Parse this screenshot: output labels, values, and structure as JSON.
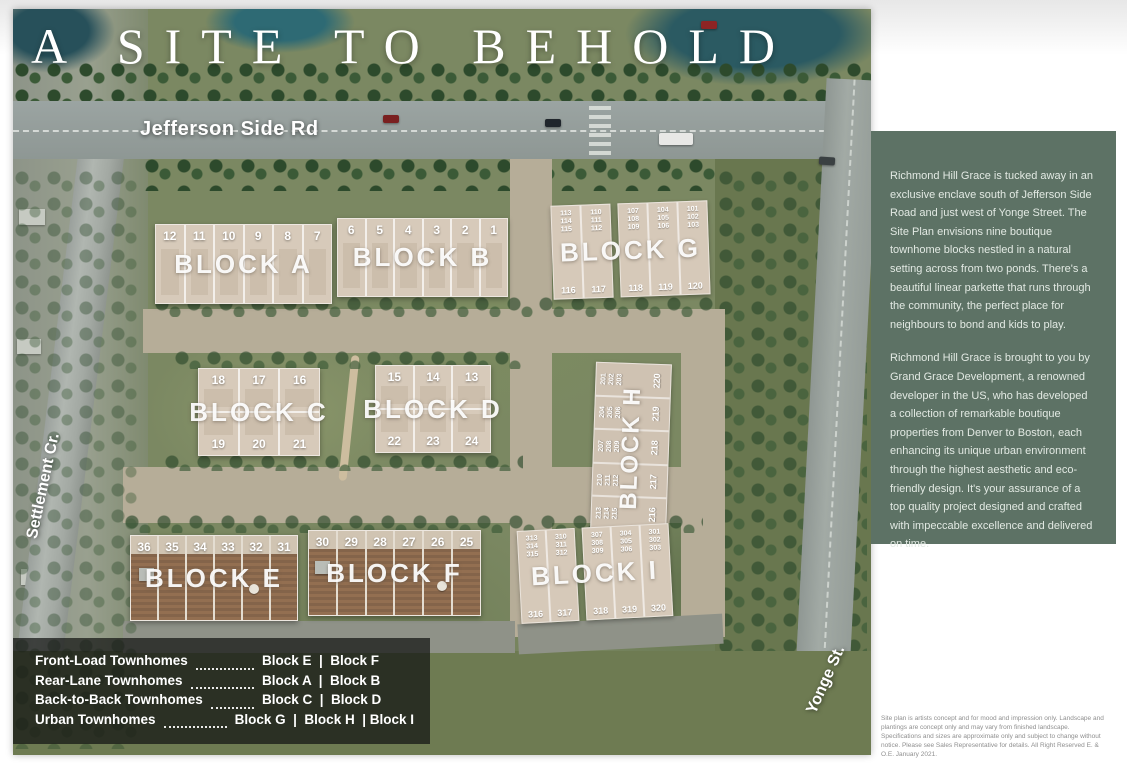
{
  "title": "A SITE TO BEHOLD",
  "streets": {
    "jefferson": "Jefferson Side Rd",
    "settlement": "Settlement Cr.",
    "yonge": "Yonge St."
  },
  "blocks": {
    "a": {
      "label": "BLOCK A",
      "units": [
        "12",
        "11",
        "10",
        "9",
        "8",
        "7"
      ]
    },
    "b": {
      "label": "BLOCK B",
      "units": [
        "6",
        "5",
        "4",
        "3",
        "2",
        "1"
      ]
    },
    "c": {
      "label": "BLOCK C",
      "units_top": [
        "18",
        "17",
        "16"
      ],
      "units_bottom": [
        "19",
        "20",
        "21"
      ]
    },
    "d": {
      "label": "BLOCK D",
      "units_top": [
        "15",
        "14",
        "13"
      ],
      "units_bottom": [
        "22",
        "23",
        "24"
      ]
    },
    "e": {
      "label": "BLOCK E",
      "units": [
        "36",
        "35",
        "34",
        "33",
        "32",
        "31"
      ]
    },
    "f": {
      "label": "BLOCK F",
      "units": [
        "30",
        "29",
        "28",
        "27",
        "26",
        "25"
      ]
    },
    "g": {
      "label": "BLOCK G",
      "unit_groups_top": [
        "113\n114\n115",
        "110\n111\n112",
        "107\n108\n109",
        "104\n105\n106",
        "101\n102\n103"
      ],
      "units_bottom": [
        "116",
        "117",
        "118",
        "119",
        "120"
      ]
    },
    "h": {
      "label": "BLOCK H",
      "unit_groups_left": [
        "201\n202\n203",
        "204\n205\n206",
        "207\n208\n209",
        "210\n211\n212",
        "213\n214\n215"
      ],
      "units_right": [
        "220",
        "219",
        "218",
        "217",
        "216"
      ]
    },
    "i": {
      "label": "BLOCK I",
      "unit_groups_top": [
        "313\n314\n315",
        "310\n311\n312",
        "307\n308\n309",
        "304\n305\n306",
        "301\n302\n303"
      ],
      "units_bottom": [
        "316",
        "317",
        "318",
        "319",
        "320"
      ]
    }
  },
  "legend": {
    "rows": [
      {
        "type": "Front-Load Townhomes",
        "blocks": "Block E  |  Block F"
      },
      {
        "type": "Rear-Lane Townhomes",
        "blocks": "Block A  |  Block B"
      },
      {
        "type": "Back-to-Back Townhomes",
        "blocks": "Block C  |  Block D"
      },
      {
        "type": "Urban Townhomes",
        "blocks": "Block G  |  Block H  | Block I"
      }
    ]
  },
  "side_panel": {
    "paragraph1": "Richmond Hill Grace is tucked away in an exclusive enclave south of Jefferson Side Road and just west of Yonge Street. The Site Plan envisions nine boutique townhome blocks nestled in a natural setting across from two ponds. There's a beautiful linear parkette that runs through the community, the perfect place for neighbours to bond and kids to play.",
    "paragraph2": "Richmond Hill Grace is brought to you by Grand Grace Development, a renowned developer in the US, who has developed a collection of remarkable boutique properties from Denver to Boston, each enhancing its unique urban environment through the highest aesthetic and eco-friendly design. It's your assurance of a top quality project designed and crafted with impeccable excellence and delivered on time."
  },
  "disclaimer": "Site plan is artists concept and for mood and impression only. Landscape and plantings are concept only and may vary from finished landscape. Specifications and sizes are approximate only and subject to change without notice. Please see Sales Representative for details.  All Right Reserved E. & O.E. January 2021.",
  "colors": {
    "panel_green": "#5d7265",
    "legend_overlay": "rgba(18,20,18,0.72)",
    "block_beige": "#d7caba",
    "deck_brown": "#84644a"
  }
}
